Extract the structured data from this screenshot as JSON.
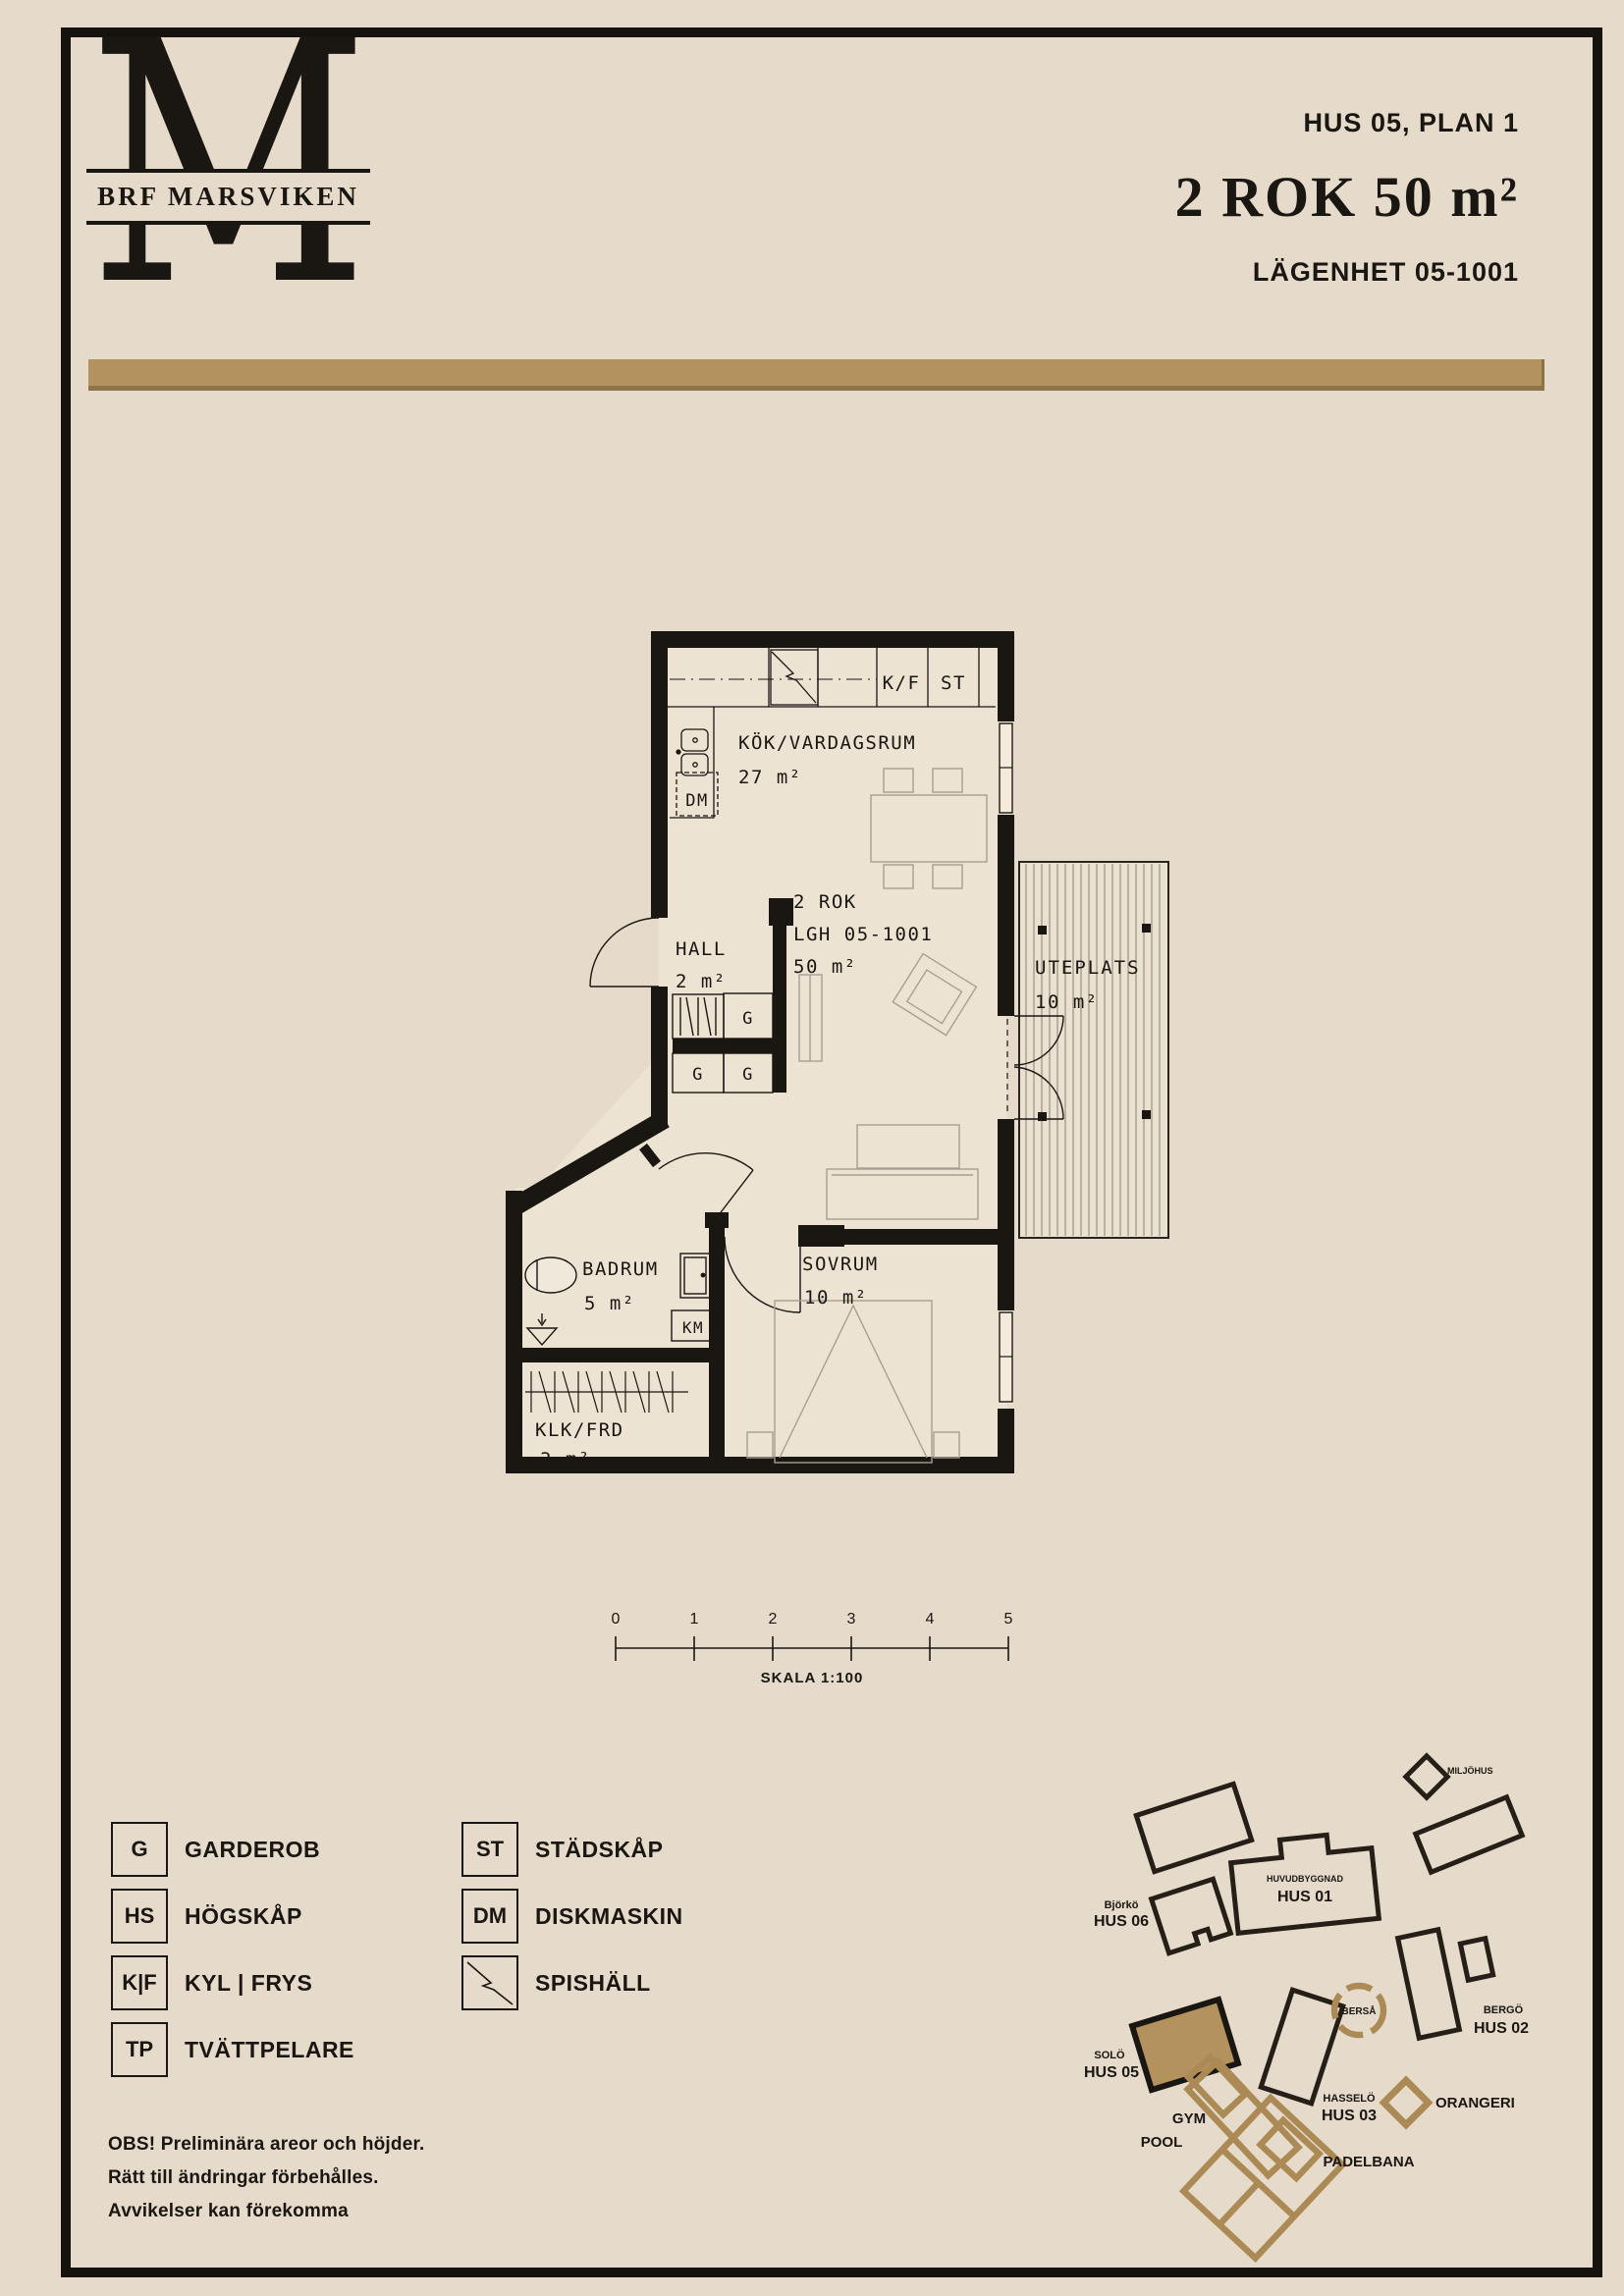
{
  "header": {
    "brand": {
      "monogram": "M",
      "name": "BRF MARSVIKEN"
    },
    "house_plan": "HUS 05, PLAN 1",
    "title": "2 ROK 50 m²",
    "apartment": "LÄGENHET 05-1001"
  },
  "floor_plan": {
    "rooms": {
      "kitchen_living": {
        "name": "KÖK/VARDAGSRUM",
        "area": "27 m²"
      },
      "hall": {
        "name": "HALL",
        "area": "2 m²"
      },
      "bathroom": {
        "name": "BADRUM",
        "area": "5 m²"
      },
      "bedroom": {
        "name": "SOVRUM",
        "area": "10 m²"
      },
      "closet": {
        "name": "KLK/FRD",
        "area": "3 m²"
      },
      "terrace": {
        "name": "UTEPLATS",
        "area": "10 m²"
      }
    },
    "unit": {
      "type": "2 ROK",
      "id": "LGH 05-1001",
      "area": "50 m²"
    },
    "fixtures": {
      "fridge_freezer": "K/F",
      "cleaning_cabinet": "ST",
      "dishwasher": "DM",
      "washer": "KM",
      "wardrobe": "G"
    }
  },
  "scale_bar": {
    "ticks": [
      "0",
      "1",
      "2",
      "3",
      "4",
      "5"
    ],
    "label": "SKALA 1:100"
  },
  "legend": {
    "column1": [
      {
        "symbol": "G",
        "label": "GARDEROB"
      },
      {
        "symbol": "HS",
        "label": "HÖGSKÅP"
      },
      {
        "symbol": "K|F",
        "label": "KYL | FRYS"
      },
      {
        "symbol": "TP",
        "label": "TVÄTTPELARE"
      }
    ],
    "column2": [
      {
        "symbol": "ST",
        "label": "STÄDSKÅP"
      },
      {
        "symbol": "DM",
        "label": "DISKMASKIN"
      },
      {
        "symbol": "",
        "label": "SPISHÄLL"
      }
    ]
  },
  "site_map": {
    "buildings": {
      "miljohus": "MILJÖHUS",
      "hus01_sub": "HUVUDBYGGNAD",
      "hus01": "HUS 01",
      "hus02_sub": "BERGÖ",
      "hus02": "HUS 02",
      "hus03_sub": "HASSELÖ",
      "hus03": "HUS 03",
      "hus05_sub": "SOLÖ",
      "hus05": "HUS 05",
      "hus06_sub": "Björkö",
      "hus06": "HUS 06",
      "bersa": "BERSÅ",
      "orangeri": "ORANGERI",
      "gym": "GYM",
      "pool": "POOL",
      "padelbana": "PADELBANA"
    }
  },
  "disclaimer": {
    "line1": "OBS! Preliminära areor och höjder.",
    "line2": "Rätt till ändringar förbehålles.",
    "line3": "Avvikelser kan förekomma"
  },
  "colors": {
    "background": "#e6dbca",
    "accent_gold": "#b3925e",
    "wall": "#1a1612",
    "floor": "#ede3d3"
  }
}
